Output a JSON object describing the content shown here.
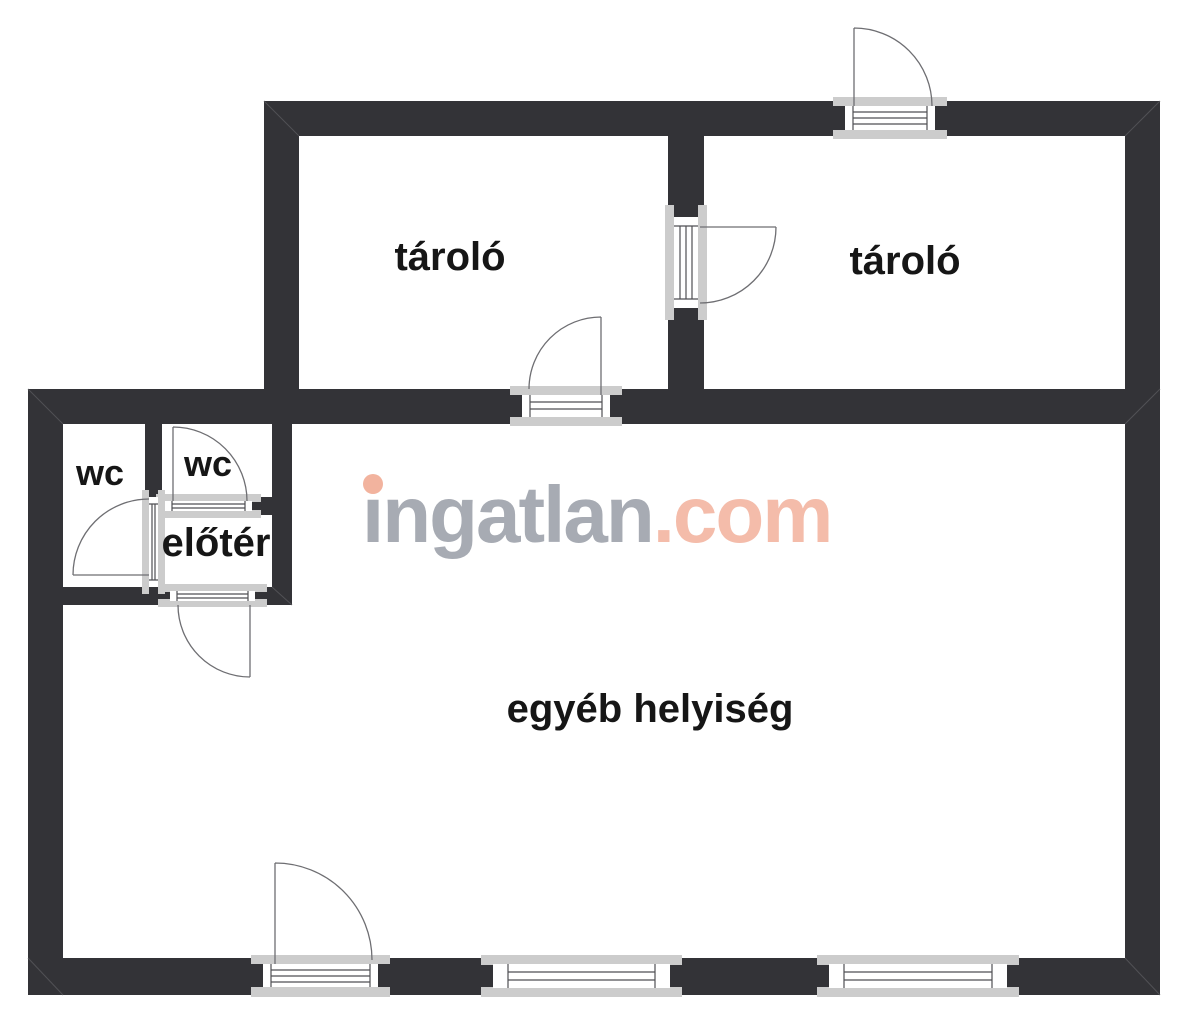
{
  "watermark": {
    "brand": "ingatlan",
    "tld": ".com",
    "full_text": "ingatlan.com"
  },
  "rooms": {
    "storage_left": {
      "label": "tároló"
    },
    "storage_right": {
      "label": "tároló"
    },
    "wc_left": {
      "label": "wc"
    },
    "wc_right": {
      "label": "wc"
    },
    "hall": {
      "label": "előtér"
    },
    "other": {
      "label": "egyéb helyiség"
    }
  },
  "colors": {
    "background": "#ffffff",
    "wall": "#333337",
    "frame_fill": "#cccccc",
    "frame_inner": "#ffffff",
    "frame_line": "#4f4f53",
    "door_line": "#6e6e72",
    "mitre": "#515155",
    "label": "#161616",
    "watermark_gray": "#a7abb3",
    "watermark_accent": "#f4bcaa",
    "watermark_dot": "#f2b39e"
  }
}
